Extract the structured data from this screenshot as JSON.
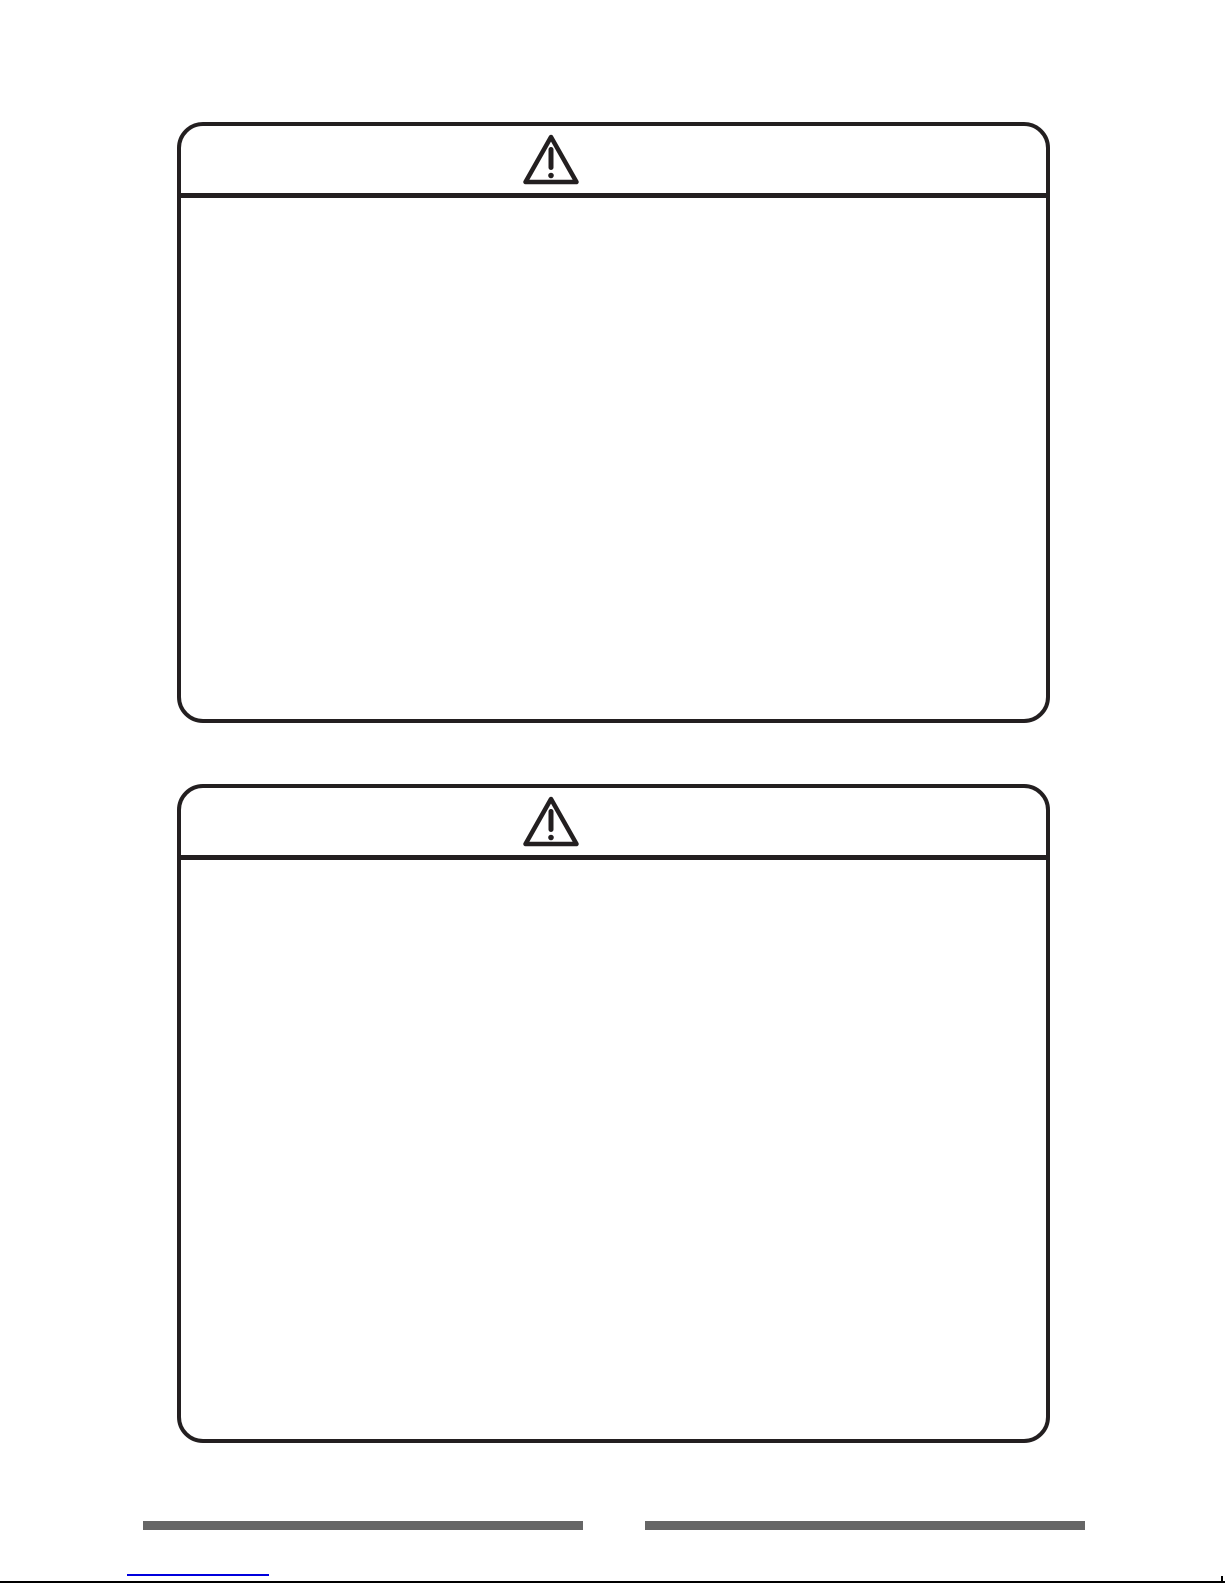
{
  "page": {
    "kind": "scanned-manual-page",
    "background": "#ffffff"
  },
  "colors": {
    "ink": "#231f20",
    "footer_bar": "#666666",
    "link": "#0000dd",
    "page_edge": "#000000"
  },
  "warning_boxes": [
    {
      "id": "warning-box-top",
      "icon": "warning-triangle"
    },
    {
      "id": "warning-box-bottom",
      "icon": "warning-triangle"
    }
  ],
  "footer": {
    "bar_count": 2,
    "has_link_underline": true
  }
}
